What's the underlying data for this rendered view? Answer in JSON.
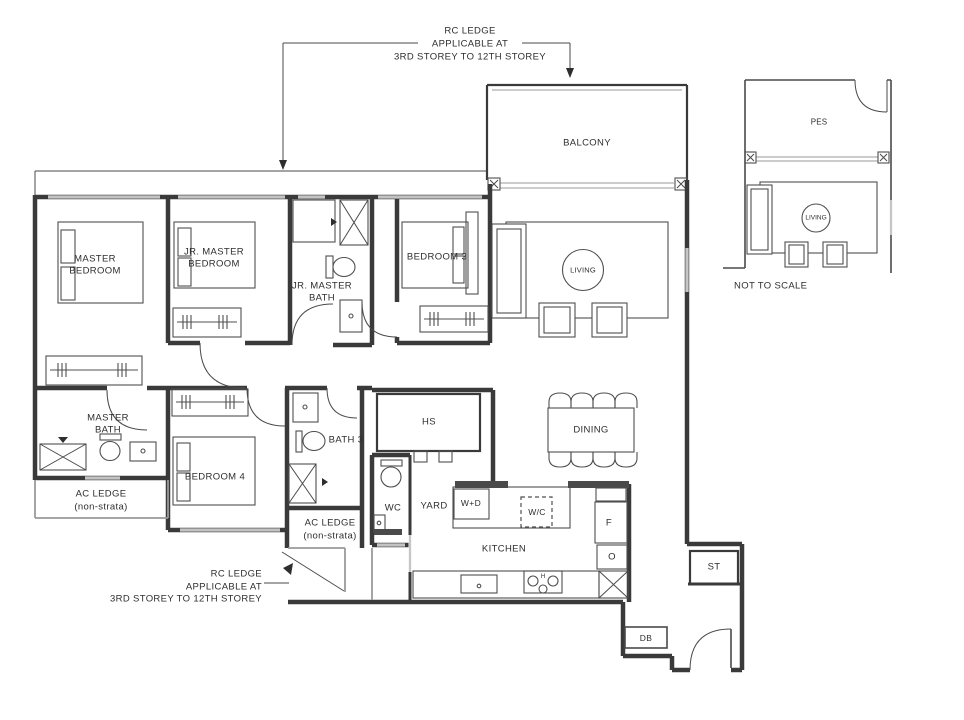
{
  "title": "Residential unit floor plan",
  "colors": {
    "wall": "#3a3a3a",
    "window": "#9a9a9a",
    "ledge": "#9a9a9a",
    "text": "#2e2e2e",
    "dark_fixture": "#4a4a4a",
    "background": "#ffffff"
  },
  "labels": {
    "rc_note": [
      "RC LEDGE",
      "APPLICABLE AT",
      "3RD STOREY TO 12TH STOREY"
    ],
    "ac_ledge": [
      "AC LEDGE",
      "(non-strata)"
    ],
    "rooms": {
      "balcony": "BALCONY",
      "master_bedroom": [
        "MASTER",
        "BEDROOM"
      ],
      "jr_master_bedroom": [
        "JR. MASTER",
        "BEDROOM"
      ],
      "jr_master_bath": [
        "JR. MASTER",
        "BATH"
      ],
      "bedroom3": "BEDROOM 3",
      "living": "LIVING",
      "master_bath": [
        "MASTER",
        "BATH"
      ],
      "bedroom4": "BEDROOM 4",
      "bath3": "BATH 3",
      "hs": "HS",
      "dining": "DINING",
      "wc": "WC",
      "yard": "YARD",
      "wd": "W+D",
      "wc_chiller": "W/C",
      "kitchen": "KITCHEN",
      "fridge": "F",
      "oven": "O",
      "store": "ST",
      "db": "DB",
      "hob": "H"
    },
    "inset": {
      "pes": "PES",
      "living": "LIVING",
      "not_to_scale": "NOT TO SCALE"
    }
  }
}
